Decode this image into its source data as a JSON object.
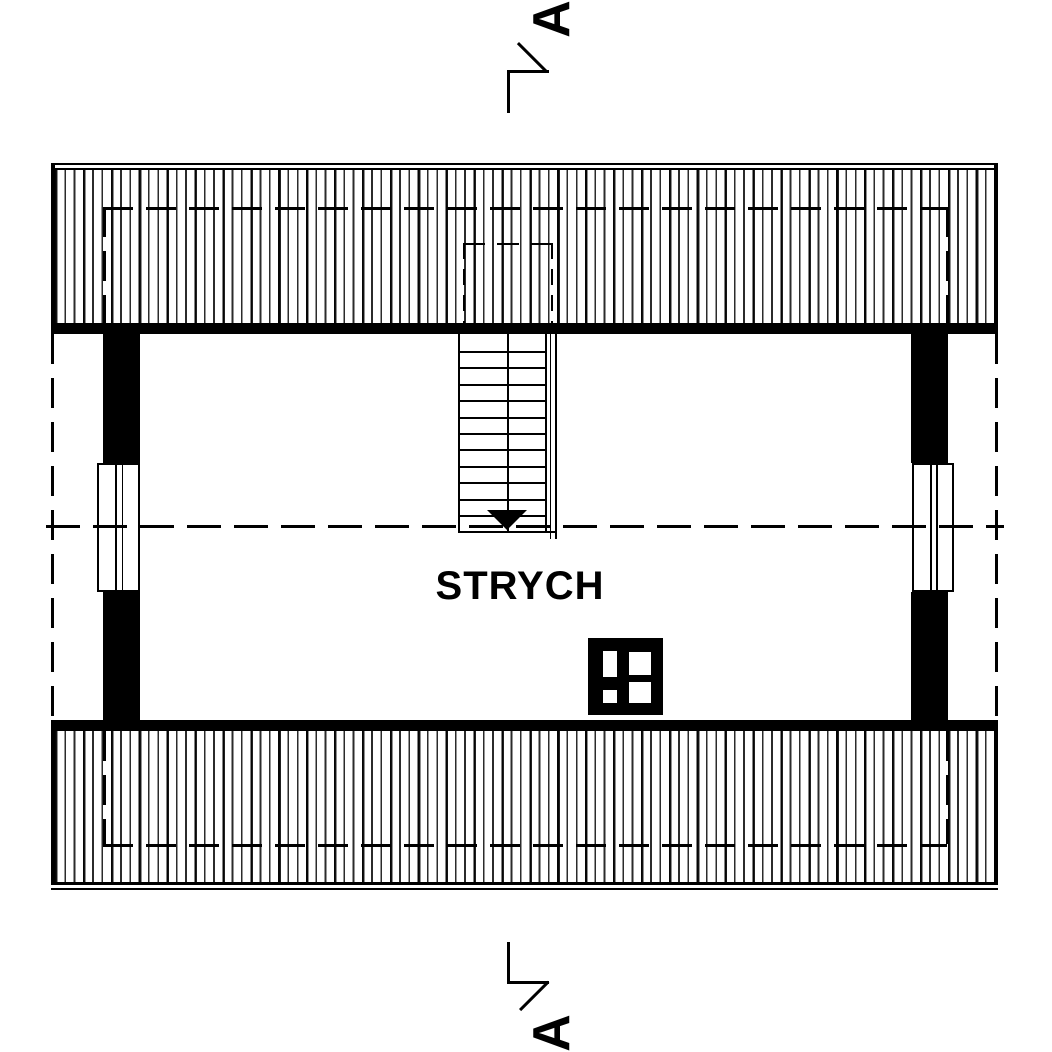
{
  "plan": {
    "room_label": "STRYCH",
    "section": {
      "top_letter": "A",
      "bottom_letter": "A"
    },
    "stairs": {
      "tread_lines": 11,
      "direction_arrow": "down"
    },
    "symbols": {
      "roof": "hatched-roof-plane",
      "chimney": "chimney-with-flues",
      "window": "plan-window",
      "stairs": "stair-run"
    },
    "colors": {
      "ink": "#000000",
      "paper": "#ffffff"
    }
  }
}
